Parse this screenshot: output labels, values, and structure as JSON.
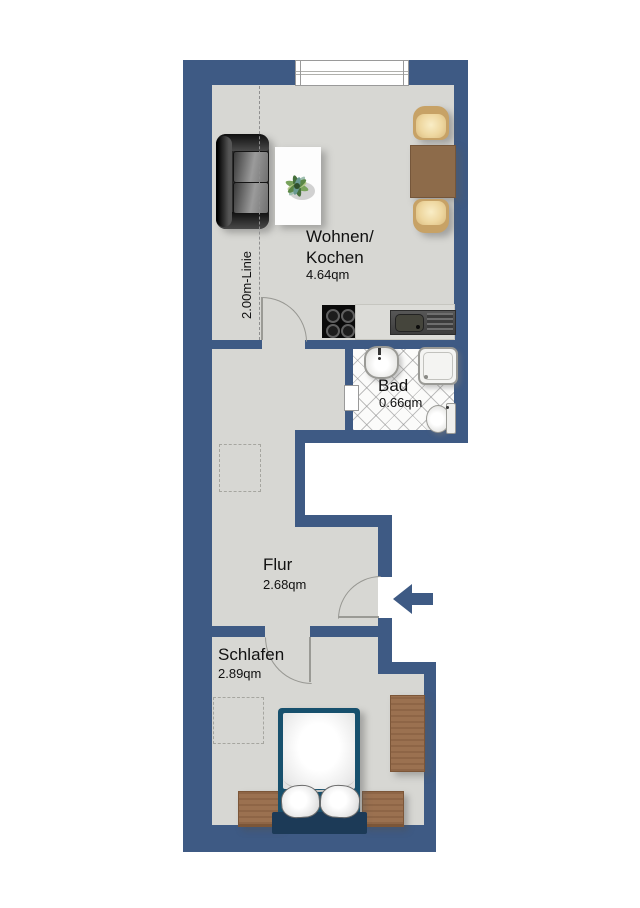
{
  "plan": {
    "rooms": {
      "wohnen": {
        "label_line1": "Wohnen/",
        "label_line2": "Kochen",
        "area": "4.64qm"
      },
      "bad": {
        "label": "Bad",
        "area": "0.66qm"
      },
      "flur": {
        "label": "Flur",
        "area": "2.68qm"
      },
      "schlafen": {
        "label": "Schlafen",
        "area": "2.89qm"
      }
    },
    "annotations": {
      "height_line": "2.00m-Linie"
    },
    "colors": {
      "wall": "#3e5a84",
      "floor": "#d7d7d3",
      "bed_frame": "#17506d",
      "wood": "#9b7150",
      "chair_cushion": "#eed7a0",
      "sofa": "#2b2b2b",
      "entrance_arrow": "#3e5a84",
      "tile_line": "#8c8c8c"
    }
  }
}
